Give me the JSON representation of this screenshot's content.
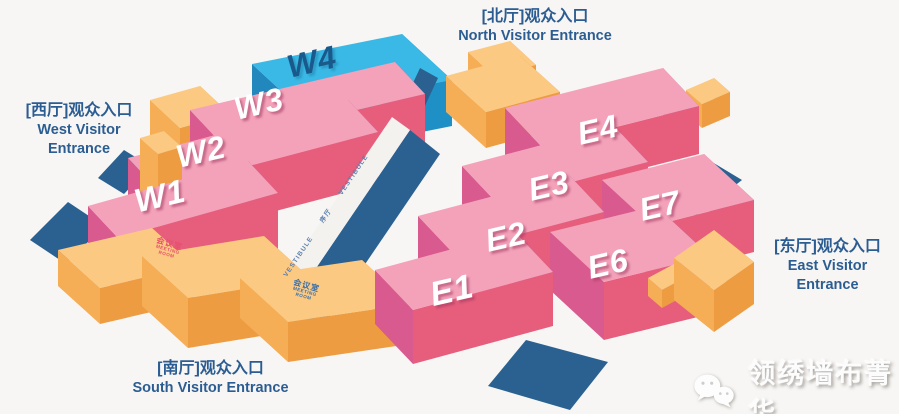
{
  "page": {
    "width": 899,
    "height": 414,
    "background": "#f7f6f4"
  },
  "entrances": {
    "north": {
      "cn": "[北厅]观众入口",
      "en": "North Visitor Entrance"
    },
    "west": {
      "cn": "[西厅]观众入口",
      "en": "West Visitor Entrance"
    },
    "east": {
      "cn": "[东厅]观众入口",
      "en": "East Visitor Entrance"
    },
    "south": {
      "cn": "[南厅]观众入口",
      "en": "South Visitor Entrance"
    }
  },
  "vestibule": {
    "en": "VESTIBULE",
    "cn": "序厅"
  },
  "meeting_room": {
    "cn": "会议室",
    "en_line1": "MEETING",
    "en_line2": "ROOM"
  },
  "watermark": {
    "text": "领绣墙布菁华",
    "icon": "wechat-icon"
  },
  "colors": {
    "background": "#f7f6f4",
    "navy": "#2a6191",
    "white_walk": "#f4f2ef",
    "entrance_text": "#2c5d92",
    "meeting_red": "#e94f6e",
    "meeting_blue": "#3a6fa8",
    "vestibule_text": "#5b7fae",
    "watermark_text": "#fcfcfc",
    "schemes": {
      "pink": {
        "top": "#f3a2ba",
        "left": "#d85a8e",
        "front": "#e65e7c",
        "right": "#9c5095"
      },
      "cyan": {
        "top": "#3ab9e6",
        "left": "#2187bd",
        "front": "#1f90c5",
        "right": "#1a79af"
      },
      "orange": {
        "top": "#fbc982",
        "left": "#f5ad56",
        "front": "#ee9c41",
        "right": "#e28f3a"
      }
    }
  },
  "map": {
    "hall_labels": [
      {
        "label": "W1",
        "pos": [
          160,
          196
        ],
        "scheme": "pink",
        "size": 33
      },
      {
        "label": "W2",
        "pos": [
          201,
          152
        ],
        "scheme": "pink",
        "size": 32
      },
      {
        "label": "W3",
        "pos": [
          259,
          104
        ],
        "scheme": "pink",
        "size": 32
      },
      {
        "label": "W4",
        "pos": [
          312,
          62
        ],
        "scheme": "cyan",
        "size": 32
      },
      {
        "label": "E1",
        "pos": [
          452,
          291
        ],
        "scheme": "pink",
        "size": 34
      },
      {
        "label": "E2",
        "pos": [
          506,
          237
        ],
        "scheme": "pink",
        "size": 32
      },
      {
        "label": "E3",
        "pos": [
          549,
          186
        ],
        "scheme": "pink",
        "size": 32
      },
      {
        "label": "E4",
        "pos": [
          598,
          130
        ],
        "scheme": "pink",
        "size": 32
      },
      {
        "label": "E6",
        "pos": [
          608,
          264
        ],
        "scheme": "pink",
        "size": 32
      },
      {
        "label": "E7",
        "pos": [
          660,
          206
        ],
        "scheme": "pink",
        "size": 32
      }
    ],
    "shapes": [
      {
        "kind": "flat",
        "name": "plaza-pad-northwest-upper",
        "fill": "navy",
        "pts": [
          [
            98,
            178
          ],
          [
            124,
            150
          ],
          [
            150,
            166
          ],
          [
            124,
            194
          ]
        ]
      },
      {
        "kind": "flat",
        "name": "plaza-pad-northwest-lower",
        "fill": "navy",
        "pts": [
          [
            30,
            240
          ],
          [
            68,
            202
          ],
          [
            104,
            226
          ],
          [
            66,
            264
          ]
        ]
      },
      {
        "kind": "box",
        "name": "hall-w4",
        "scheme": "cyan",
        "p": [
          252,
          64
        ],
        "u": [
          150,
          -30
        ],
        "v": [
          50,
          46
        ],
        "h": 46
      },
      {
        "kind": "flat",
        "name": "plaza-pad-north",
        "fill": "navy",
        "pts": [
          [
            392,
            128
          ],
          [
            420,
            68
          ],
          [
            438,
            78
          ],
          [
            410,
            138
          ]
        ]
      },
      {
        "kind": "box",
        "name": "north-entrance-hall-back",
        "scheme": "orange",
        "p": [
          468,
          52
        ],
        "u": [
          42,
          -11
        ],
        "v": [
          26,
          24
        ],
        "h": 28
      },
      {
        "kind": "box",
        "name": "north-entrance-hall",
        "scheme": "orange",
        "p": [
          446,
          76
        ],
        "u": [
          74,
          -20
        ],
        "v": [
          40,
          36
        ],
        "h": 36
      },
      {
        "kind": "box",
        "name": "west-entrance-hall",
        "scheme": "orange",
        "p": [
          150,
          100
        ],
        "u": [
          50,
          -14
        ],
        "v": [
          30,
          28
        ],
        "h": 40
      },
      {
        "kind": "box",
        "name": "hall-w3",
        "scheme": "pink",
        "p": [
          190,
          110
        ],
        "u": [
          205,
          -48
        ],
        "v": [
          30,
          32
        ],
        "h": 50
      },
      {
        "kind": "box",
        "name": "hall-w2",
        "scheme": "pink",
        "p": [
          128,
          158
        ],
        "u": [
          220,
          -58
        ],
        "v": [
          30,
          32
        ],
        "h": 52
      },
      {
        "kind": "box",
        "name": "west-meeting-annex",
        "scheme": "orange",
        "p": [
          140,
          138
        ],
        "u": [
          24,
          -7
        ],
        "v": [
          18,
          16
        ],
        "h": 62
      },
      {
        "kind": "box",
        "name": "hall-w1",
        "scheme": "pink",
        "p": [
          88,
          206
        ],
        "u": [
          160,
          -45
        ],
        "v": [
          30,
          32
        ],
        "h": 56
      },
      {
        "kind": "flat",
        "name": "vestibule-floor",
        "fill": "navy",
        "pts": [
          [
            276,
            327
          ],
          [
            410,
            130
          ],
          [
            440,
            154
          ],
          [
            306,
            351
          ]
        ]
      },
      {
        "kind": "flat",
        "name": "vestibule-walkway",
        "fill": "white_walk",
        "pts": [
          [
            258,
            314
          ],
          [
            392,
            117
          ],
          [
            410,
            130
          ],
          [
            276,
            327
          ]
        ]
      },
      {
        "kind": "box",
        "name": "south-meeting-west",
        "scheme": "orange",
        "p": [
          58,
          250
        ],
        "u": [
          94,
          -22
        ],
        "v": [
          42,
          38
        ],
        "h": 36
      },
      {
        "kind": "box",
        "name": "south-meeting-center",
        "scheme": "orange",
        "p": [
          142,
          256
        ],
        "u": [
          122,
          -20
        ],
        "v": [
          46,
          42
        ],
        "h": 50
      },
      {
        "kind": "box",
        "name": "south-meeting-east",
        "scheme": "orange",
        "p": [
          240,
          278
        ],
        "u": [
          122,
          -18
        ],
        "v": [
          48,
          44
        ],
        "h": 40
      },
      {
        "kind": "flat",
        "name": "plaza-pad-southeast",
        "fill": "navy",
        "pts": [
          [
            488,
            386
          ],
          [
            526,
            340
          ],
          [
            608,
            362
          ],
          [
            570,
            410
          ]
        ]
      },
      {
        "kind": "box",
        "name": "east-annex-north",
        "scheme": "orange",
        "p": [
          686,
          90
        ],
        "u": [
          28,
          -12
        ],
        "v": [
          16,
          14
        ],
        "h": 24
      },
      {
        "kind": "box",
        "name": "hall-e4",
        "scheme": "pink",
        "p": [
          505,
          108
        ],
        "u": [
          158,
          -40
        ],
        "v": [
          36,
          38
        ],
        "h": 48
      },
      {
        "kind": "box",
        "name": "hall-e3",
        "scheme": "pink",
        "p": [
          462,
          166
        ],
        "u": [
          152,
          -40
        ],
        "v": [
          34,
          36
        ],
        "h": 52
      },
      {
        "kind": "flat",
        "name": "plaza-pad-east",
        "fill": "navy",
        "pts": [
          [
            656,
            192
          ],
          [
            702,
            156
          ],
          [
            742,
            180
          ],
          [
            696,
            216
          ]
        ]
      },
      {
        "kind": "box",
        "name": "hall-e7",
        "scheme": "pink",
        "p": [
          602,
          180
        ],
        "u": [
          102,
          -26
        ],
        "v": [
          50,
          46
        ],
        "h": 52
      },
      {
        "kind": "box",
        "name": "hall-e2",
        "scheme": "pink",
        "p": [
          418,
          216
        ],
        "u": [
          152,
          -40
        ],
        "v": [
          34,
          36
        ],
        "h": 54
      },
      {
        "kind": "box",
        "name": "hall-e6",
        "scheme": "pink",
        "p": [
          550,
          232
        ],
        "u": [
          106,
          -26
        ],
        "v": [
          54,
          50
        ],
        "h": 58
      },
      {
        "kind": "box",
        "name": "hall-e1",
        "scheme": "pink",
        "p": [
          375,
          270
        ],
        "u": [
          140,
          -38
        ],
        "v": [
          38,
          40
        ],
        "h": 54
      },
      {
        "kind": "box",
        "name": "east-annex-south",
        "scheme": "orange",
        "p": [
          648,
          278
        ],
        "u": [
          26,
          -14
        ],
        "v": [
          14,
          12
        ],
        "h": 18
      },
      {
        "kind": "box",
        "name": "east-entrance-hall",
        "scheme": "orange",
        "p": [
          674,
          258
        ],
        "u": [
          40,
          -28
        ],
        "v": [
          40,
          32
        ],
        "h": 42
      }
    ]
  }
}
